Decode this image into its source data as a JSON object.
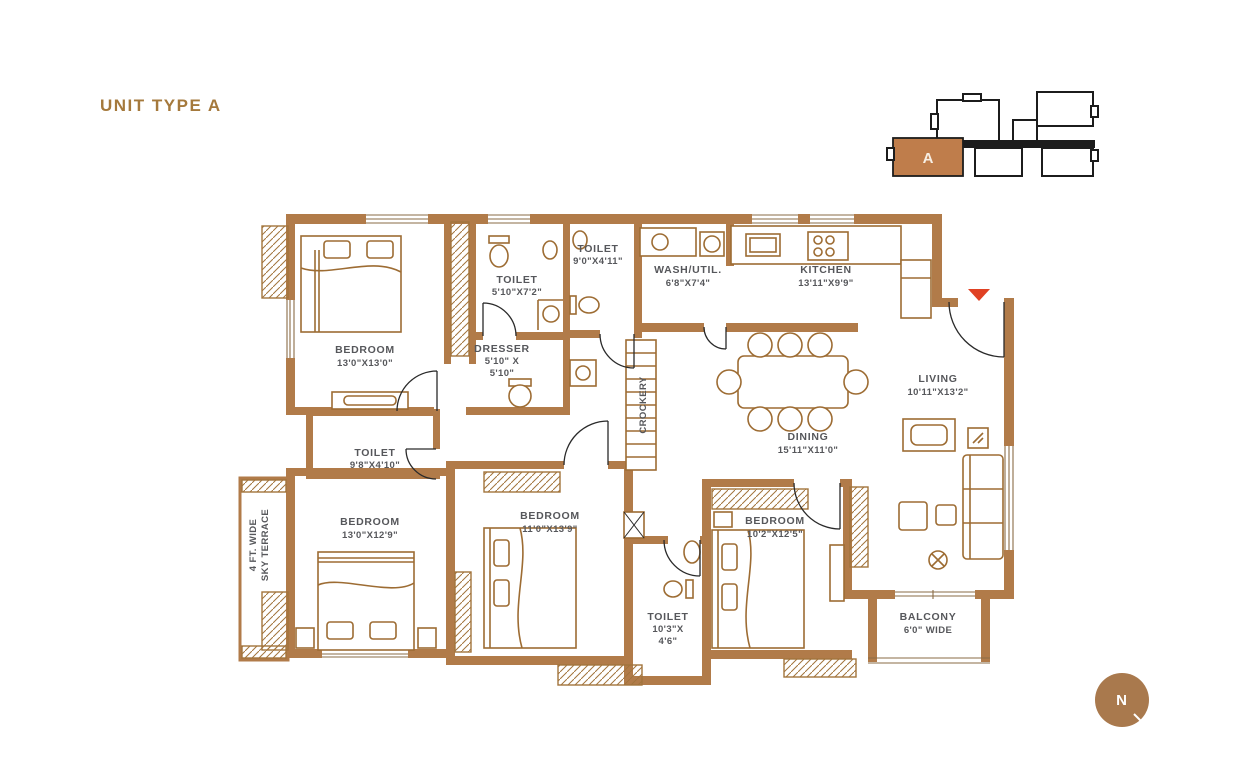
{
  "title": "UNIT TYPE A",
  "key_plan": {
    "unit_label": "A"
  },
  "compass": {
    "label": "N"
  },
  "colors": {
    "wall": "#b17b49",
    "furniture": "#9d6c33",
    "label_text": "#56575b",
    "title_text": "#a5793c",
    "keyplan_unit_fill": "#bf7d4b",
    "entry_marker": "#e04123",
    "compass_fill": "#a9794d"
  },
  "rooms": [
    {
      "id": "bedroom-1",
      "name": "BEDROOM",
      "dims": "13'0\"X13'0\""
    },
    {
      "id": "toilet-1",
      "name": "TOILET",
      "dims": "5'10\"X7'2\""
    },
    {
      "id": "toilet-2",
      "name": "TOILET",
      "dims": "9'0\"X4'11\""
    },
    {
      "id": "wash-util",
      "name": "WASH/UTIL.",
      "dims": "6'8\"X7'4\""
    },
    {
      "id": "kitchen",
      "name": "KITCHEN",
      "dims": "13'11\"X9'9\""
    },
    {
      "id": "dresser",
      "name": "DRESSER",
      "dims": "5'10\" X",
      "dims2": "5'10\""
    },
    {
      "id": "crockery",
      "name": "CROCKERY"
    },
    {
      "id": "toilet-3",
      "name": "TOILET",
      "dims": "9'8\"X4'10\""
    },
    {
      "id": "dining",
      "name": "DINING",
      "dims": "15'11\"X11'0\""
    },
    {
      "id": "living",
      "name": "LIVING",
      "dims": "10'11\"X13'2\""
    },
    {
      "id": "bedroom-2",
      "name": "BEDROOM",
      "dims": "13'0\"X12'9\""
    },
    {
      "id": "bedroom-3",
      "name": "BEDROOM",
      "dims": "11'0\"X13'9\""
    },
    {
      "id": "bedroom-4",
      "name": "BEDROOM",
      "dims": "10'2\"X12'5\""
    },
    {
      "id": "toilet-4",
      "name": "TOILET",
      "dims": "10'3\"X",
      "dims2": "4'6\""
    },
    {
      "id": "balcony",
      "name": "BALCONY",
      "dims": "6'0\" WIDE"
    },
    {
      "id": "sky-terrace",
      "name": "4 FT. WIDE",
      "name2": "SKY TERRACE"
    }
  ]
}
